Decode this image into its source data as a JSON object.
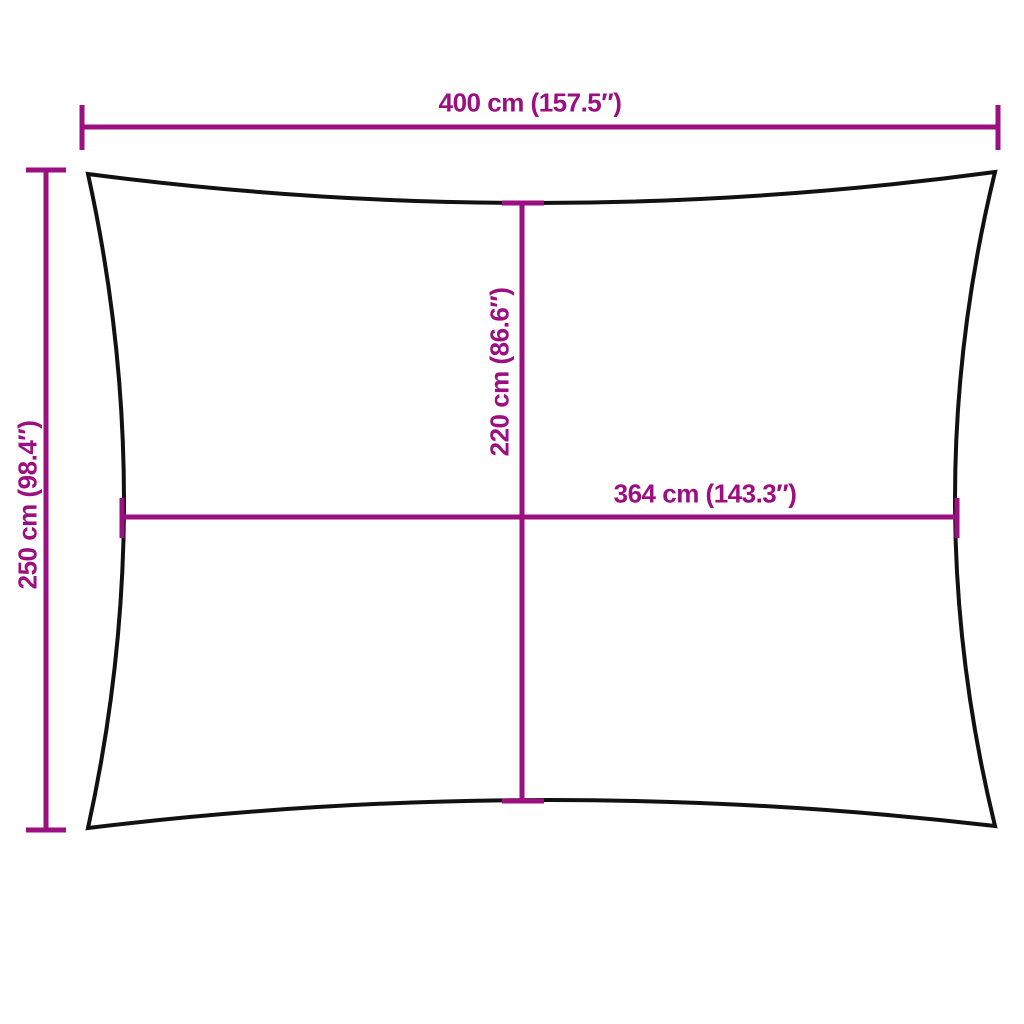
{
  "diagram": {
    "labels": {
      "width_top": "400 cm (157.5″)",
      "height_left": "250 cm (98.4″)",
      "inner_height": "220 cm (86.6″)",
      "inner_width": "364 cm (143.3″)"
    },
    "measurements": {
      "width_top_cm": 400,
      "width_top_in": 157.5,
      "height_left_cm": 250,
      "height_left_in": 98.4,
      "inner_height_cm": 220,
      "inner_height_in": 86.6,
      "inner_width_cm": 364,
      "inner_width_in": 143.3
    },
    "colors": {
      "dimension": "#9b0f80",
      "outline": "#111111",
      "background": "#ffffff"
    }
  }
}
